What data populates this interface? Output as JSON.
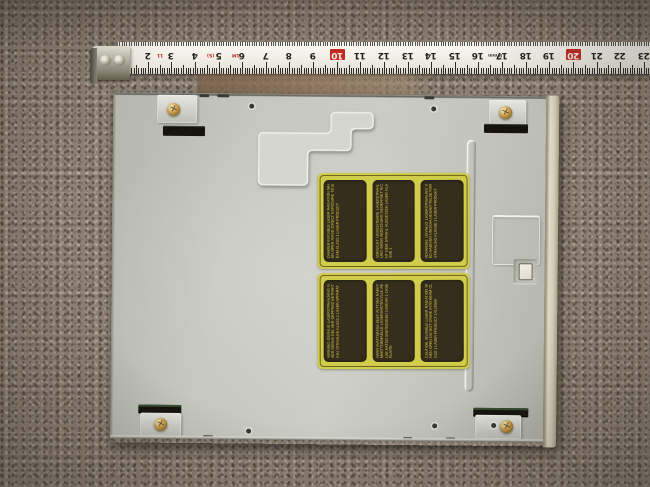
{
  "scene": {
    "type": "photograph",
    "subject": "Bottom view of a beige internal optical disc drive lying on grey-brown carpet, with a steel tape measure laid along the top edge",
    "colors": {
      "carpet": "#8d8276",
      "chassis_metal": "#c5c7bf",
      "tape_face": "#f2f0e8",
      "tape_red": "#c22a22",
      "label_yellow": "#d2cc4b",
      "label_panel_dark": "#352e1d",
      "brass_screw": "#c79c4c",
      "bezel_plastic": "#dbd4c2"
    }
  },
  "tape": {
    "unit": "cm",
    "orientation": "digits printed upside-down (tape rotated 180°)",
    "numbers": [
      2,
      3,
      4,
      5,
      6,
      7,
      8,
      9,
      10,
      11,
      12,
      13,
      14,
      15,
      16,
      17,
      18,
      19,
      20,
      21,
      22,
      23
    ],
    "red_numbers": [
      10,
      20
    ],
    "micro_marks": [
      {
        "cm": 2.4,
        "text": "11",
        "color": "#c22a22"
      },
      {
        "cm": 4.5,
        "text": "(S)",
        "color": "#c22a22"
      },
      {
        "cm": 5.55,
        "text": "1M",
        "color": "#c22a22"
      },
      {
        "cm": 16.4,
        "text": "8 mm",
        "color": "#44423c"
      }
    ]
  },
  "drive": {
    "screws": {
      "count": 4,
      "type": "brass phillips screws in corner tabs"
    },
    "labels": {
      "description": "Six dark panels with tiny yellow multilingual laser-warning text on two yellow stickers",
      "panels": [
        "DANGER INVISIBLE LASER RADIATION WHEN OPEN AVOID DIRECT EXPOSURE TO BEAM CLASS 1 LASER PRODUCT",
        "VORSICHT UNSICHTBARE LASERSTRAHLUNG WENN ABDECKUNG GEOEFFNET NICHT DEM STRAHL AUSSETZEN LASER KLASSE 1",
        "ADVARSEL USYNLIG LASERSTRAALING VED AABNING UNDGAA UDSAETTELSE FOR STRAALING KLASSE 1 LASER PRODUKT",
        "VARNING OSYNLIG LASERSTRAALNING NAER DENNA DEL AER OEPPNAD BETRAKTA EJ STRAALEN KLASS 1 LASER APPARAT",
        "VARO AVATTAESSA OLET ALTTIINA NAEKYMAETTOEMAELLE LASERSAETEILYLLE AELAE KATSO SAETEESEEN LUOKAN 1 LASERLAITE",
        "CAUTION INVISIBLE LASER RADIATION WHEN OPEN DO NOT STARE INTO BEAM CLASS 1 LASER PRODUCT 1412890A"
      ]
    }
  }
}
